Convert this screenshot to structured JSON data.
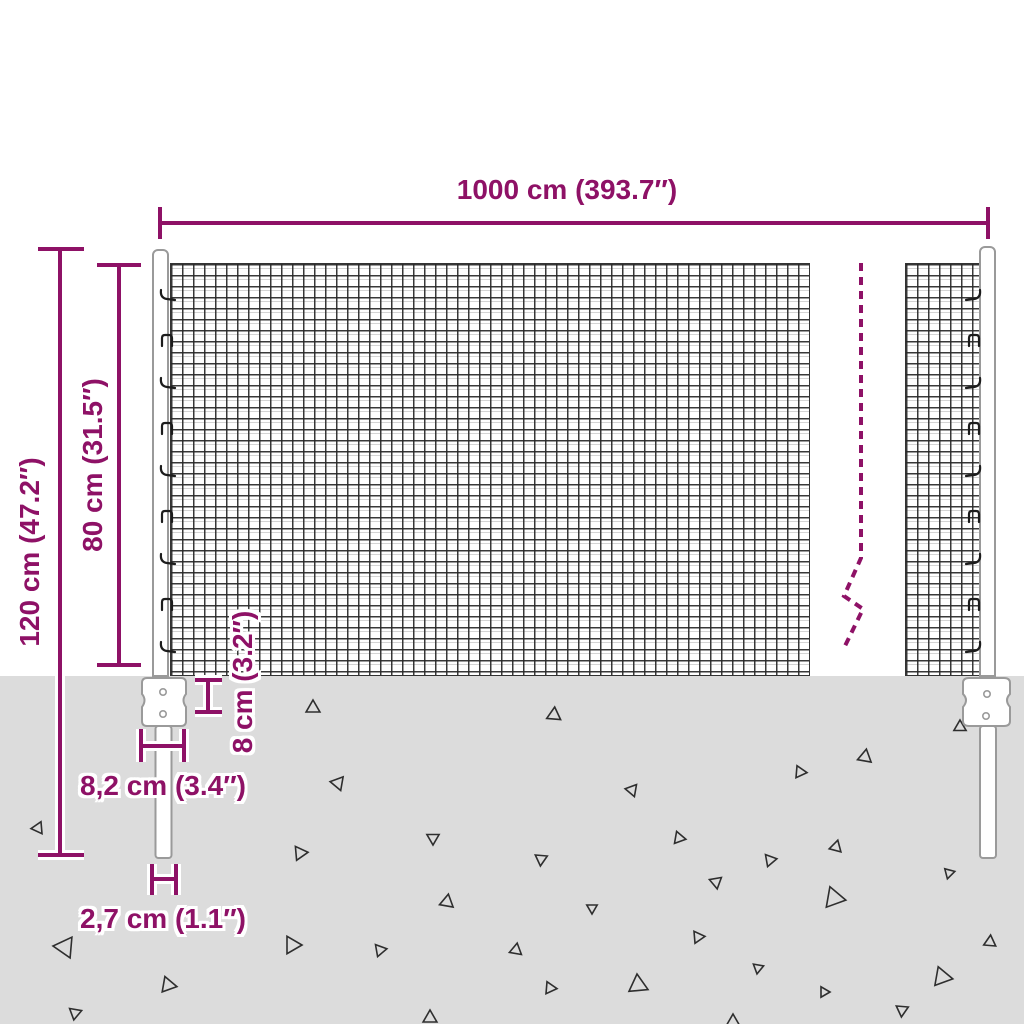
{
  "colors": {
    "accent": "#8e1166",
    "ground": "#dcdcdc",
    "mesh_line": "#333333",
    "outline": "#9a9a9a",
    "triangle": "#2e2e2e"
  },
  "labels": {
    "width": "1000 cm (393.7″)",
    "total_height": "120 cm (47.2″)",
    "mesh_height": "80 cm (31.5″)",
    "plate_height": "8 cm (3.2″)",
    "plate_width": "8,2 cm (3.4″)",
    "post_width": "2,7 cm (1.1″)"
  },
  "ground": {
    "triangles": [
      [
        313,
        708,
        8,
        0
      ],
      [
        338,
        783,
        8,
        40
      ],
      [
        38,
        828,
        7,
        25
      ],
      [
        300,
        853,
        8,
        85
      ],
      [
        433,
        838,
        7,
        60
      ],
      [
        447,
        902,
        8,
        10
      ],
      [
        65,
        947,
        12,
        35
      ],
      [
        292,
        945,
        10,
        90
      ],
      [
        380,
        950,
        7,
        80
      ],
      [
        168,
        985,
        9,
        100
      ],
      [
        75,
        1013,
        7,
        70
      ],
      [
        430,
        1018,
        8,
        120
      ],
      [
        554,
        715,
        8,
        5
      ],
      [
        960,
        727,
        7,
        0
      ],
      [
        865,
        757,
        8,
        10
      ],
      [
        800,
        772,
        7,
        95
      ],
      [
        632,
        790,
        7,
        40
      ],
      [
        679,
        838,
        7,
        100
      ],
      [
        836,
        847,
        7,
        15
      ],
      [
        541,
        859,
        7,
        65
      ],
      [
        770,
        860,
        7,
        80
      ],
      [
        949,
        873,
        6,
        75
      ],
      [
        716,
        882,
        7,
        50
      ],
      [
        834,
        898,
        12,
        100
      ],
      [
        592,
        908,
        6,
        60
      ],
      [
        698,
        937,
        7,
        85
      ],
      [
        516,
        950,
        7,
        10
      ],
      [
        990,
        942,
        7,
        5
      ],
      [
        758,
        968,
        6,
        70
      ],
      [
        638,
        985,
        11,
        115
      ],
      [
        550,
        988,
        7,
        95
      ],
      [
        942,
        977,
        11,
        100
      ],
      [
        824,
        992,
        6,
        90
      ],
      [
        902,
        1010,
        7,
        65
      ],
      [
        733,
        1022,
        8,
        120
      ]
    ]
  },
  "hooks": {
    "start_y": 290,
    "spacing": 44,
    "count": 9,
    "left_x": 160,
    "right_x": 981
  }
}
